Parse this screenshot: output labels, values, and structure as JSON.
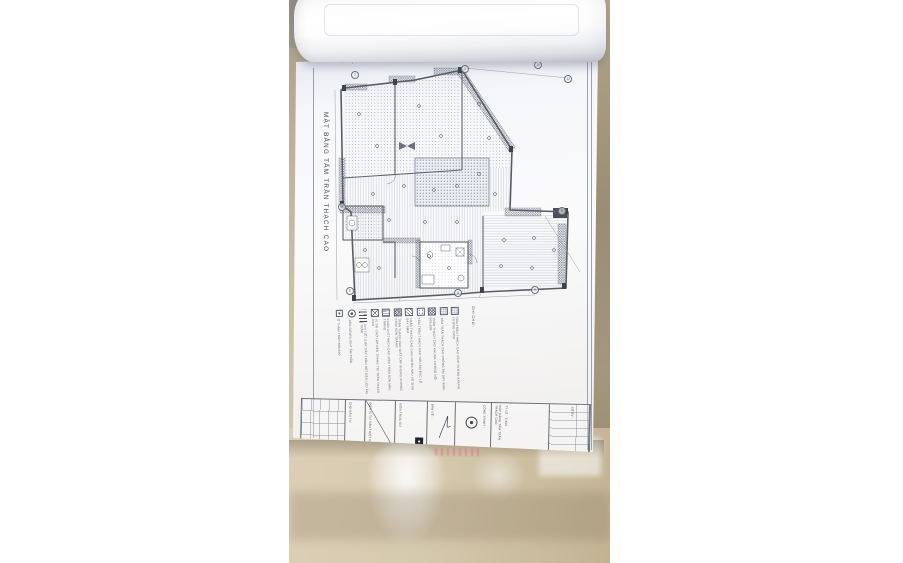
{
  "sheet": {
    "title": "MẶT BẰNG TẤM TRẦN THẠCH CAO",
    "legend_title": "GHI CHÚ :",
    "legend_items": [
      {
        "pattern": "sqdot",
        "label": "Ô THĂM TRẦN 600x600"
      },
      {
        "pattern": "lamp",
        "label": "ĐÈN DOWNLIGHT ÂM TRẦN"
      },
      {
        "pattern": "stack",
        "label": "CHI TIẾT GIẬT CẤP TRẦN HẮT ĐÈN LED ÂM TRẦN"
      },
      {
        "pattern": "xbox",
        "label": "VỊ TRÍ CHỜ LẮP ĐÈN TRANG TRÍ TRẦN THẠCH CAO"
      },
      {
        "pattern": "hlines",
        "label": "PHÀO CHỈ THẠCH CAO VIỀN TRẦN SƠN MÀU TRẮNG"
      },
      {
        "pattern": "hatchdense",
        "label": "TRẦN THẠCH CAO GIẬT CẤP KHUNG XƯƠNG CHÌM SƠN TRẮNG"
      },
      {
        "pattern": "hatch",
        "label": "TRẦN THẠCH CAO CHỊU NƯỚC KHU VỆ SINH DÀY 9MM"
      },
      {
        "pattern": "dotscoarse",
        "label": "TẤM TRẦN THẠCH CAO TIÊU ÂM ĐỤC LỖ"
      },
      {
        "pattern": "checker",
        "label": "TRẦN THẠCH CAO KHUNG XƯƠNG NỔI 600x600"
      },
      {
        "pattern": "dotsfine",
        "label": "TẤM TRẦN THẠCH CAO CHỐNG ẨM DÀY 9MM"
      },
      {
        "pattern": "dotsfine",
        "label": "TẤM TRẦN THẠCH CAO VĨNH TƯỜNG KHUNG XƯƠNG CHÌM"
      }
    ],
    "grid_bubbles": [
      {
        "x": 62,
        "y": 71,
        "label": "2"
      },
      {
        "x": 172,
        "y": 65,
        "label": "3"
      },
      {
        "x": 245,
        "y": 61,
        "label": "10"
      },
      {
        "x": 275,
        "y": 75,
        "label": "12"
      },
      {
        "x": 49,
        "y": 203,
        "label": "D"
      },
      {
        "x": 57,
        "y": 287,
        "label": "E"
      },
      {
        "x": 165,
        "y": 289,
        "label": "8"
      },
      {
        "x": 242,
        "y": 286,
        "label": "9"
      },
      {
        "x": 269,
        "y": 207,
        "label": "B"
      }
    ],
    "title_block": {
      "owner_label": "CHỦ ĐẦU TƯ",
      "consultant_label": "ĐƠN VỊ TƯ VẤN THIẾT KẾ",
      "architect_label": "KIẾN TRÚC SƯ",
      "drawing_label": "BẢN VẼ :",
      "project_label": "CÔNG TRÌNH :",
      "drawing_name": "MẶT BẰNG TẤM TRẦN THẠCH CAO",
      "scale_label": "TỶ LỆ : 1/100",
      "date_label": "NGÀY :",
      "number_label": "SỐ BV :"
    }
  },
  "colors": {
    "marble": "#cfc3a8",
    "marble_dark": "#9a8d72",
    "sheet": "#f8f8fa",
    "wall_line": "#5f646c",
    "watermark_pink": "#e8909a"
  }
}
